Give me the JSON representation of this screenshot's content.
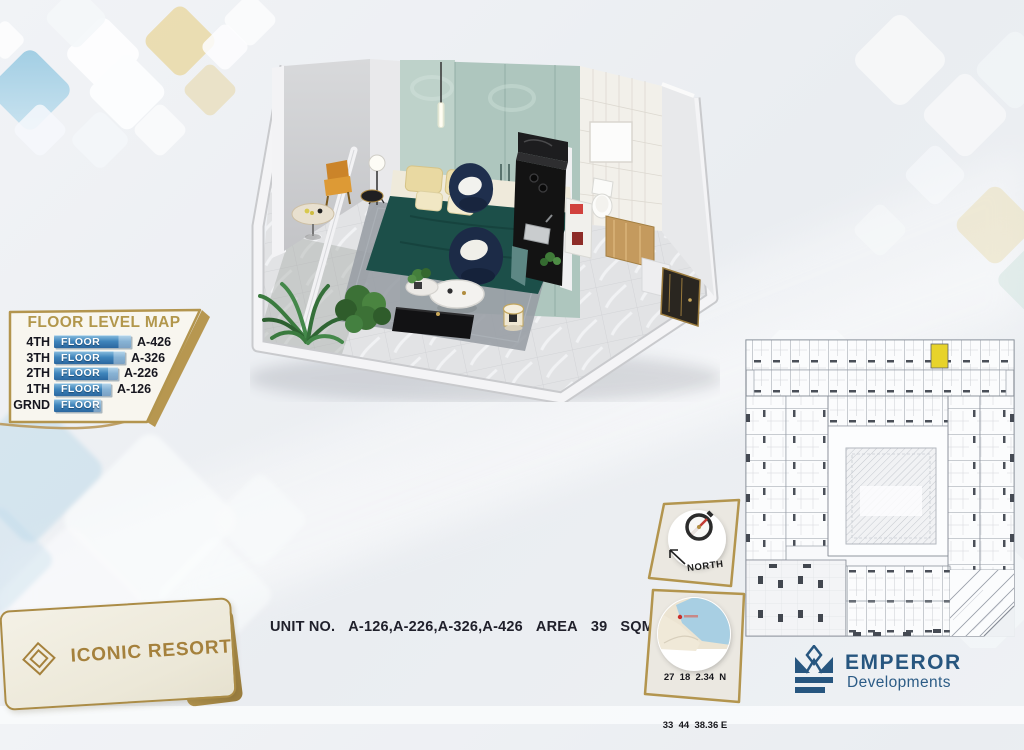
{
  "floor_level_map": {
    "title": "FLOOR LEVEL MAP",
    "rows": [
      {
        "level": "4TH",
        "floor_label": "FLOOR",
        "unit": "A-426"
      },
      {
        "level": "3TH",
        "floor_label": "FLOOR",
        "unit": "A-326"
      },
      {
        "level": "2TH",
        "floor_label": "FLOOR",
        "unit": "A-226"
      },
      {
        "level": "1TH",
        "floor_label": "FLOOR",
        "unit": "A-126"
      },
      {
        "level": "GRND",
        "floor_label": "FLOOR",
        "unit": ""
      }
    ]
  },
  "unit_bar": {
    "label": "UNIT NO.",
    "units": "A-126,A-226,A-326,A-426",
    "area_label": "AREA",
    "area_value": "39",
    "area_unit": "SQM"
  },
  "compass_badge": {
    "label": "NORTH"
  },
  "location_badge": {
    "line1": "27  18  2.34  N",
    "line2": "33  44  38.36 E"
  },
  "resort": {
    "name": "ICONIC RESORT"
  },
  "developer": {
    "name": "EMPEROR",
    "division": "Developments"
  },
  "floor_plan": {
    "highlighted_unit_color": "#e7d32b"
  },
  "icons": {
    "compass": "compass-dial-icon",
    "north_arrow": "northwest-arrow-icon",
    "location_map": "map-pin-icon",
    "resort_logo": "nested-diamond-icon",
    "developer_logo": "crown-e-icon"
  },
  "colors": {
    "gold": "#b3954e",
    "navy": "#27567f",
    "bar_blue": "#3f85bc",
    "cream": "#f3f0e4"
  }
}
